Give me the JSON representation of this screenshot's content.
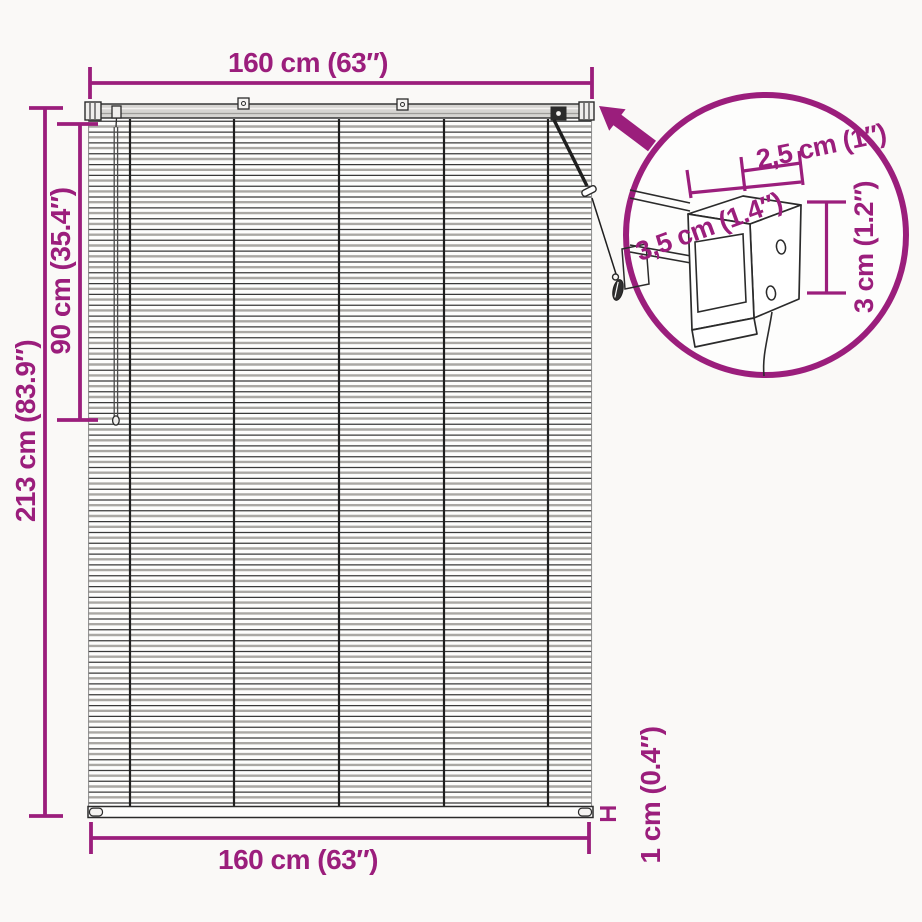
{
  "diagram": {
    "type": "product-dimension-diagram",
    "subject": "venetian-blind-with-mounting-bracket-detail",
    "colors": {
      "accent": "#9B1E7C",
      "line": "#2b2b2b",
      "rail_fill": "#d6d5d2",
      "background": "#FAF9F7"
    },
    "dimensions": {
      "top_width": "160 cm (63″)",
      "bottom_width": "160 cm (63″)",
      "total_height": "213 cm (83.9″)",
      "upper_height": "90 cm (35.4″)",
      "slat_thickness": "1 cm (0.4″)"
    },
    "bracket_detail": {
      "width": "2,5 cm (1″)",
      "depth": "3,5 cm (1.4″)",
      "height": "3 cm (1.2″)"
    }
  }
}
